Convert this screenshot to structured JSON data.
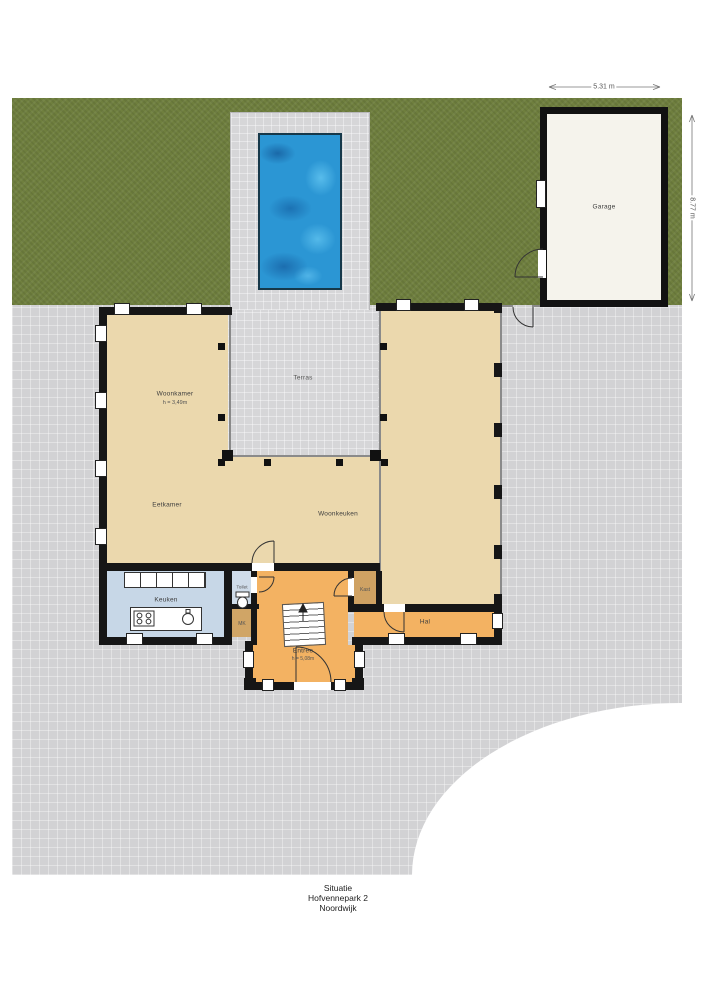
{
  "caption": {
    "line1": "Situatie",
    "line2": "Hofvennepark 2",
    "line3": "Noordwijk"
  },
  "garage": {
    "label": "Garage",
    "width_dim": "5.31 m",
    "depth_dim": "8.77 m"
  },
  "rooms": {
    "woonkamer": {
      "label": "Woonkamer",
      "height": "h = 3,49m"
    },
    "terras": {
      "label": "Terras"
    },
    "eetkamer": {
      "label": "Eetkamer"
    },
    "woonkeuken": {
      "label": "Woonkeuken"
    },
    "keuken": {
      "label": "Keuken"
    },
    "toilet": {
      "label": "Toilet"
    },
    "mk": {
      "label": "MK"
    },
    "kast": {
      "label": "Kast"
    },
    "entree": {
      "label": "Entree",
      "height": "h = 5,08m"
    },
    "hal": {
      "label": "Hal"
    }
  },
  "colors": {
    "grass": "#6f7f3e",
    "paving": "#d2d2d4",
    "pool_water": "#2b96d4",
    "floor_tan": "#ebd8ad",
    "floor_kitchen": "#c7d7e7",
    "floor_entry": "#f3b262",
    "floor_closet": "#cfa263",
    "garage_floor": "#f5f3ec",
    "wall": "#161616"
  }
}
